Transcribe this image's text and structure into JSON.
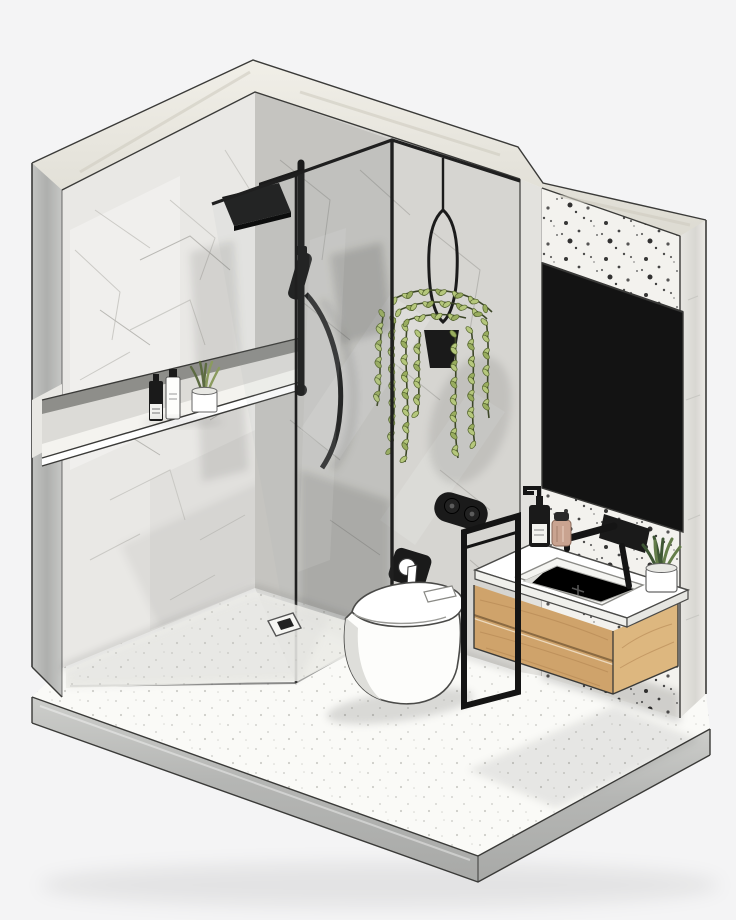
{
  "scene": {
    "label": "Isometric cutaway rendering of a modern bathroom: marble walk-in shower with black fixtures, hanging plant, wall-hung toilet, floating oak vanity with black wall faucet and large dark mirror on a terrazzo wall",
    "style": "architectural sketch render, no visible text"
  },
  "palette": {
    "bg": "#f4f4f5",
    "line": "#3a3a38",
    "band": "#ebe9e1",
    "wallL": "#e9e8e5",
    "backW": "#d6d5d1",
    "reveal": "#e3e2de",
    "terr": "#f3f2ee",
    "concrete": "#b7b8b6",
    "concreteL": "#cccdcb",
    "slabEdge": "#b3b4b2",
    "floor": "#fafaf7",
    "floorShower": "#eeeeea",
    "black": "#1a1a1a",
    "mirror": "#131313",
    "wood": "#cfa36b",
    "woodTop": "#d8ad76",
    "woodEnd": "#ddb77f",
    "grain": "#b08350",
    "white": "#ffffff",
    "porcelain": "#fdfdfb",
    "porcShade": "#dededa",
    "vein": "#c6c5c1",
    "veinD": "#b2b1ad",
    "greenLeaf": "#b5c77c",
    "greenLeaf2": "#99ad5f",
    "greenDark": "#55652f",
    "stem": "#3c4627",
    "olive": "#5c6b41",
    "olive2": "#8a9a5e",
    "dkgreen": "#3e5634",
    "dkgreen2": "#647d4a",
    "jar": "#c9a390"
  },
  "objects": [
    {
      "name": "marble-left-wall"
    },
    {
      "name": "recessed-storage-niche"
    },
    {
      "name": "shampoo-bottle-black"
    },
    {
      "name": "shampoo-bottle-white"
    },
    {
      "name": "niche-succulent-pot"
    },
    {
      "name": "rain-shower-set-black"
    },
    {
      "name": "hand-shower-and-hose"
    },
    {
      "name": "shower-mixer-valve"
    },
    {
      "name": "glass-shower-screen"
    },
    {
      "name": "floor-drain"
    },
    {
      "name": "hanging-trailing-plant"
    },
    {
      "name": "plant-hanger-ring"
    },
    {
      "name": "toilet-paper-holder"
    },
    {
      "name": "wall-hung-toilet"
    },
    {
      "name": "flush-plate"
    },
    {
      "name": "black-towel-stand"
    },
    {
      "name": "floating-oak-vanity"
    },
    {
      "name": "undermount-basin"
    },
    {
      "name": "wall-mounted-black-faucet"
    },
    {
      "name": "soap-dispenser"
    },
    {
      "name": "cosmetic-jar"
    },
    {
      "name": "counter-succulent-pot"
    },
    {
      "name": "dark-mirror-panel"
    },
    {
      "name": "terrazzo-feature-wall"
    },
    {
      "name": "concrete-floor-slab"
    }
  ]
}
